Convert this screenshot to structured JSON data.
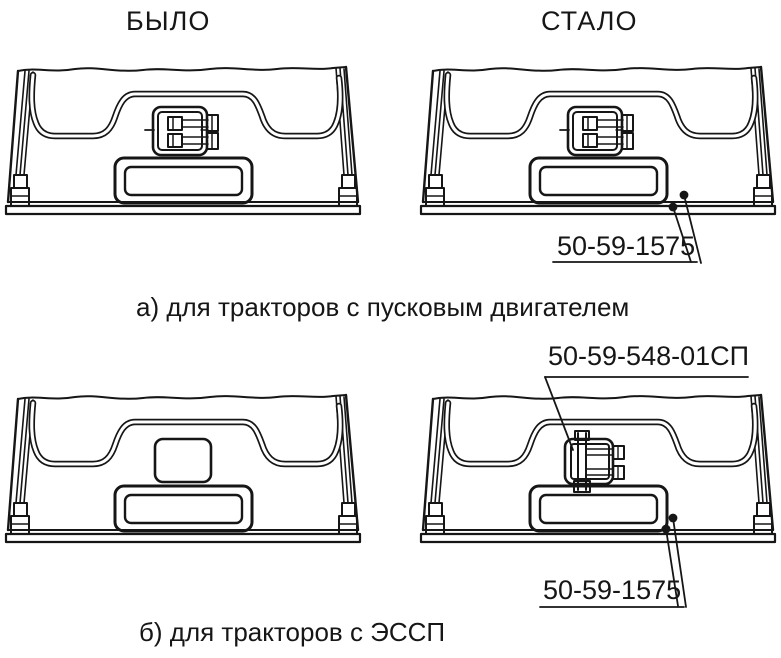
{
  "figure": {
    "headers": {
      "before": "БЫЛО",
      "after": "СТАЛО"
    },
    "captions": {
      "row_a": "а) для тракторов с пусковым двигателем",
      "row_b": "б) для тракторов с ЭССП"
    },
    "callouts": {
      "row_a_fasteners": "50-59-1575",
      "row_b_connector": "50-59-548-01СП",
      "row_b_fasteners": "50-59-1575"
    },
    "colors": {
      "line": "#161616",
      "background": "#ffffff"
    }
  }
}
